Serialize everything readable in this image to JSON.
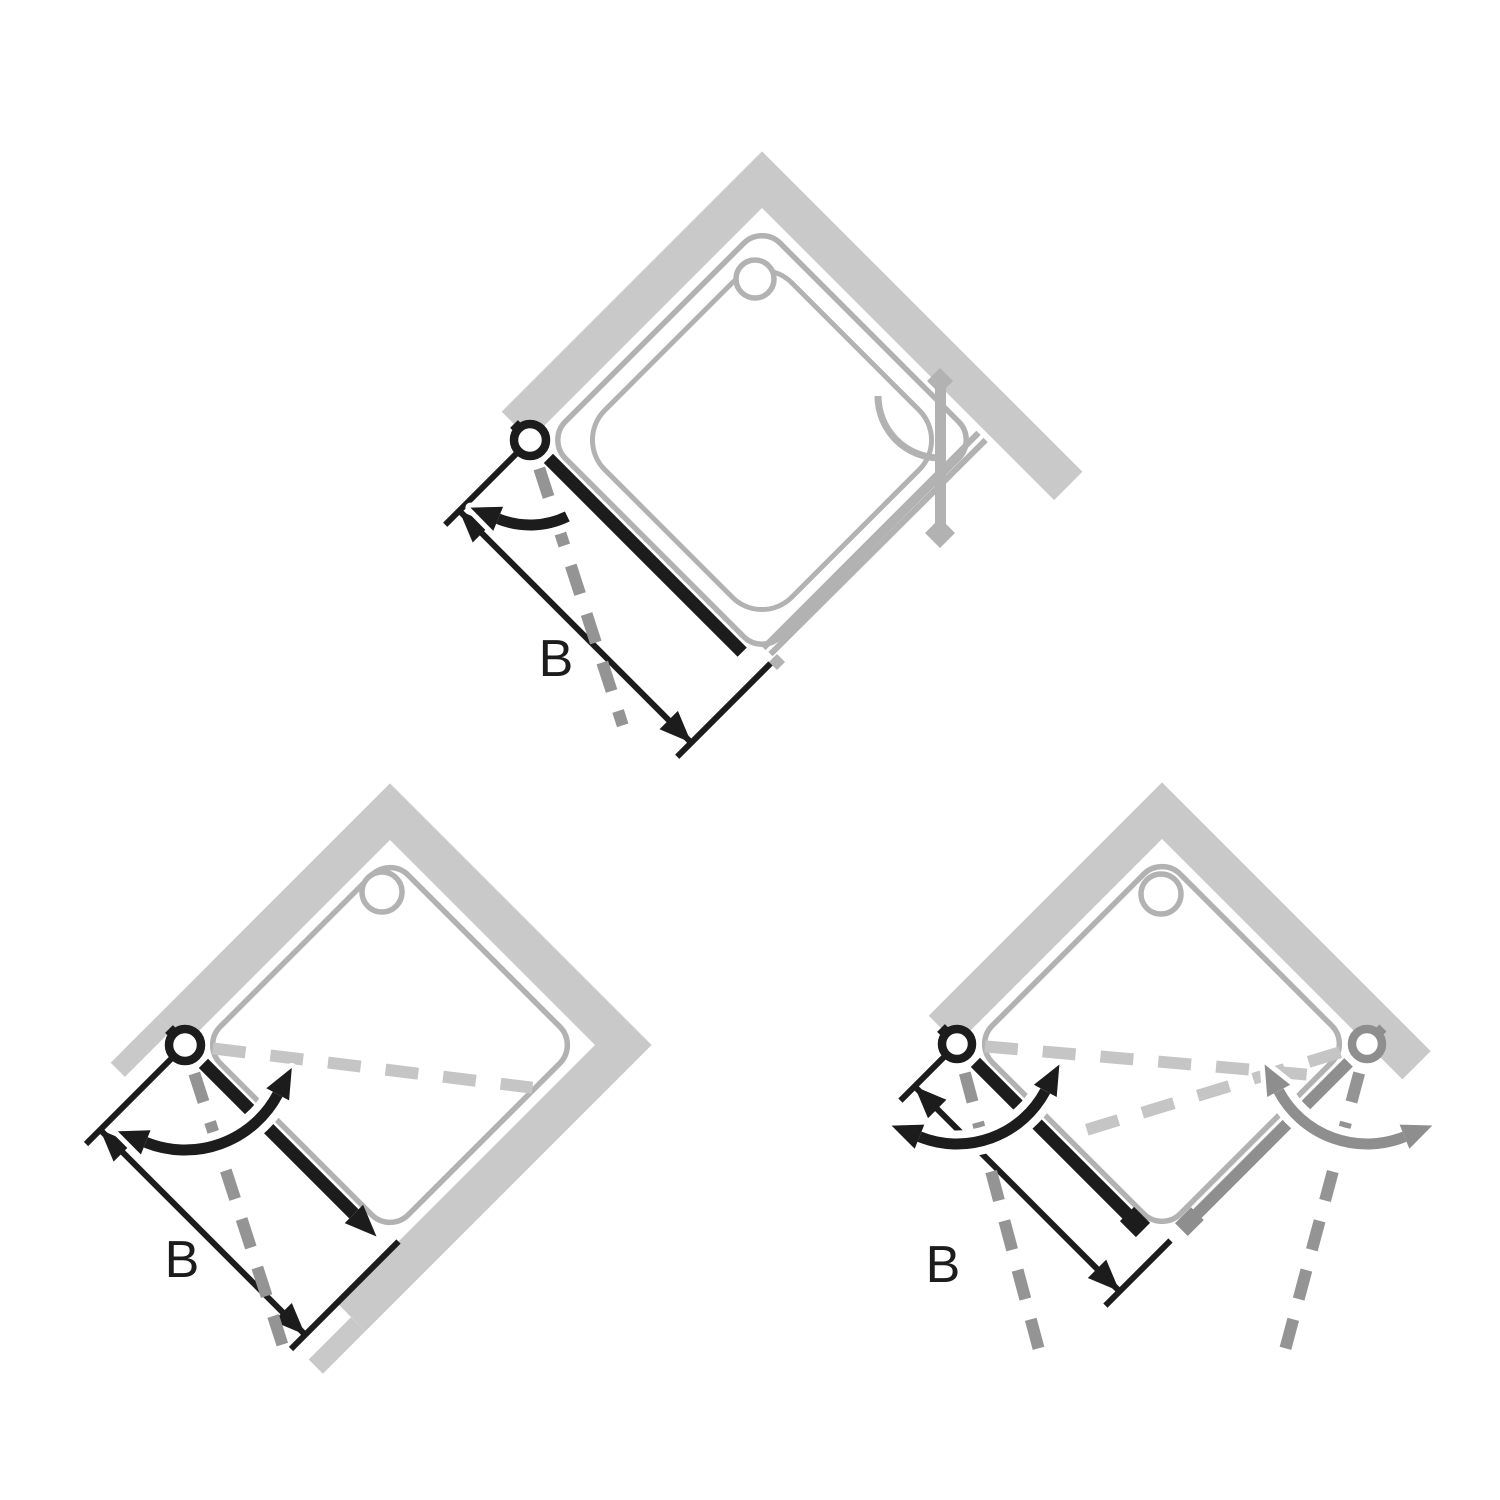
{
  "page": {
    "background": "#ffffff",
    "description_names": [
      "shower-enclosure-plan-diagrams"
    ]
  },
  "colors": {
    "wall": "#c9c9c9",
    "tray_outline": "#b2b2b2",
    "door_dark": "#1c1c1c",
    "door_gray": "#8e8e8e",
    "dashed_dark": "#949494",
    "dashed_light": "#c5c5c5",
    "dimension": "#1c1c1c"
  },
  "diagrams": [
    {
      "id": "corner-pivot-door-with-fixed-side-panel",
      "position": "top-center",
      "dimension_label": "B",
      "icon_names": [
        "shower-tray-icon",
        "drain-icon",
        "pivot-hinge-icon",
        "swing-arrow-icon",
        "dimension-arrow-icon"
      ]
    },
    {
      "id": "niche-pendulum-door",
      "position": "bottom-left",
      "dimension_label": "B",
      "icon_names": [
        "shower-tray-icon",
        "drain-icon",
        "pivot-hinge-icon",
        "double-swing-arrow-icon",
        "dimension-arrow-icon"
      ]
    },
    {
      "id": "corner-entry-double-pendulum-doors",
      "position": "bottom-right",
      "dimension_label": "B",
      "icon_names": [
        "shower-tray-icon",
        "drain-icon",
        "pivot-hinge-icon",
        "double-swing-arrow-icon",
        "dimension-arrow-icon"
      ]
    }
  ]
}
